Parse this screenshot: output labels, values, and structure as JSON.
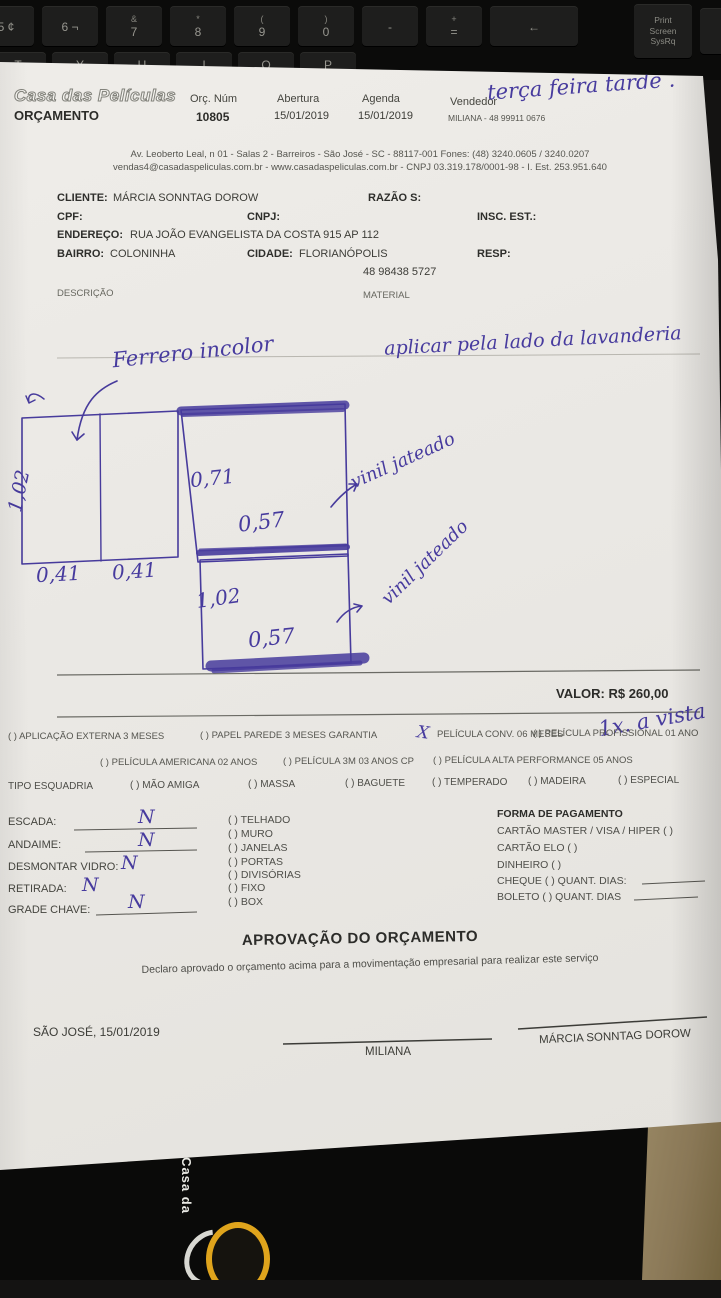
{
  "scene": {
    "keyboard": {
      "keys_row1": [
        {
          "top": "",
          "main": "5 ¢"
        },
        {
          "top": "",
          "main": "6 ¬"
        },
        {
          "top": "&",
          "main": "7"
        },
        {
          "top": "*",
          "main": "8"
        },
        {
          "top": "(",
          "main": "9"
        },
        {
          "top": ")",
          "main": "0"
        },
        {
          "top": "",
          "main": "-"
        },
        {
          "top": "+",
          "main": "="
        },
        {
          "top": "",
          "main": "←"
        }
      ],
      "keys_row2": [
        "T",
        "Y",
        "U",
        "I",
        "O",
        "P"
      ],
      "printscreen": "Print Screen SysRq"
    },
    "folder": {
      "vertical_text": "Casa da"
    }
  },
  "header": {
    "logo": "Casa das Películas",
    "title": "ORÇAMENTO",
    "orc_num_label": "Orç. Núm",
    "orc_num": "10805",
    "abertura_label": "Abertura",
    "abertura": "15/01/2019",
    "agenda_label": "Agenda",
    "agenda": "15/01/2019",
    "vendedor_label": "Vendedor",
    "vendedor": "MILIANA - 48 99911 0676",
    "handwritten_note": "terça feira tarde .",
    "address1": "Av. Leoberto Leal, n 01 - Salas 2 - Barreiros - São José - SC - 88117-001 Fones: (48) 3240.0605 / 3240.0207",
    "address2": "vendas4@casadaspeliculas.com.br - www.casadaspeliculas.com.br - CNPJ 03.319.178/0001-98 - I. Est. 253.951.640"
  },
  "client": {
    "cliente_label": "CLIENTE:",
    "cliente_value": "MÁRCIA SONNTAG DOROW",
    "razao_label": "RAZÃO S:",
    "cpf_label": "CPF:",
    "cnpj_label": "CNPJ:",
    "insc_est_label": "INSC. EST.:",
    "endereco_label": "ENDEREÇO:",
    "endereco_value": "RUA JOÃO EVANGELISTA DA COSTA 915 AP 112",
    "bairro_label": "BAIRRO:",
    "bairro_value": "COLONINHA",
    "cidade_label": "CIDADE:",
    "cidade_value": "FLORIANÓPOLIS",
    "resp_label": "RESP:",
    "telefone": "48 98438 5727",
    "descricao_label": "DESCRIÇÃO",
    "material_label": "MATERIAL"
  },
  "sketch": {
    "note_film": "Ferrero incolor",
    "note_apply": "aplicar pela lado da lavanderia",
    "left_height": "1,02",
    "left_width_1": "0,41",
    "left_width_2": "0,41",
    "top_height": "0,71",
    "top_width": "0,57",
    "bottom_height": "1,02",
    "bottom_width": "0,57",
    "film_label_1": "vinil jateado",
    "film_label_2": "vinil jateado"
  },
  "totals": {
    "valor": "VALOR: R$ 260,00",
    "payment_note": "1x. a vista"
  },
  "warranty": {
    "check_mark": "X",
    "row1": [
      "(  ) APLICAÇÃO EXTERNA 3 MESES",
      "(  ) PAPEL PAREDE 3 MESES GARANTIA",
      "PELÍCULA CONV. 06 MESES",
      "(  ) PELÍCULA PROFISSIONAL 01 ANO"
    ],
    "row2": [
      "(  ) PELÍCULA AMERICANA 02 ANOS",
      "(  ) PELÍCULA 3M 03 ANOS CP",
      "(  ) PELÍCULA ALTA PERFORMANCE 05 ANOS"
    ]
  },
  "esquadria": {
    "label": "TIPO ESQUADRIA",
    "options": [
      "(  ) MÃO AMIGA",
      "(  ) MASSA",
      "(  ) BAGUETE",
      "(  ) TEMPERADO",
      "(  ) MADEIRA",
      "(  ) ESPECIAL"
    ]
  },
  "site": {
    "fields": [
      {
        "label": "ESCADA:",
        "value": "N"
      },
      {
        "label": "ANDAIME:",
        "value": "N"
      },
      {
        "label": "DESMONTAR VIDRO:",
        "value": "N"
      },
      {
        "label": "RETIRADA:",
        "value": "N"
      },
      {
        "label": "GRADE CHAVE:",
        "value": "N"
      }
    ],
    "locations": [
      "(  ) TELHADO",
      "(  ) MURO",
      "(  ) JANELAS",
      "(  ) PORTAS",
      "(  ) DIVISÓRIAS",
      "(  ) FIXO",
      "(  ) BOX"
    ]
  },
  "payment": {
    "title": "FORMA DE PAGAMENTO",
    "methods": [
      "CARTÃO MASTER / VISA / HIPER   (   )",
      "CARTÃO ELO   (   )",
      "DINHEIRO   (   )",
      "CHEQUE   (   )   QUANT. DIAS:",
      "BOLETO   (   )   QUANT. DIAS"
    ]
  },
  "approval": {
    "title": "APROVAÇÃO DO ORÇAMENTO",
    "declaration": "Declaro aprovado o orçamento acima para a movimentação empresarial para realizar este serviço",
    "city_date": "SÃO JOSÉ, 15/01/2019",
    "sign1": "MILIANA",
    "sign2": "MÁRCIA SONNTAG DOROW"
  }
}
